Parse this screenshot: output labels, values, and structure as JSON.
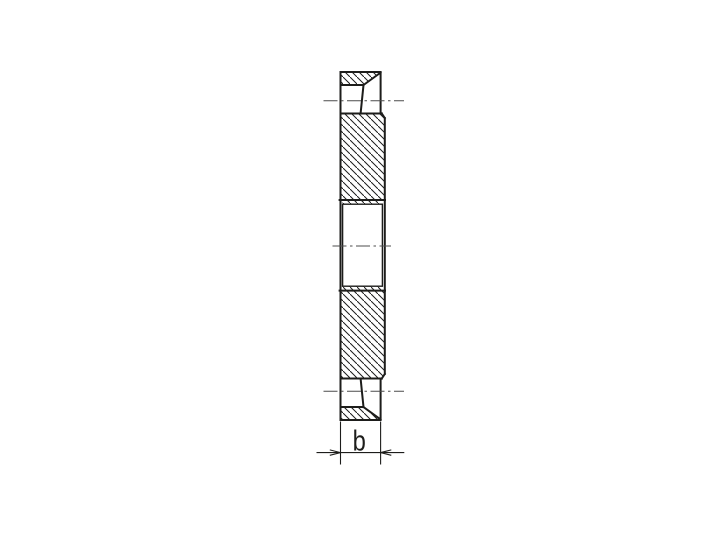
{
  "drawing": {
    "dimension_label": "b",
    "colors": {
      "background": "#ffffff",
      "line": "#1d1d1b",
      "centerline": "#4c4c4c",
      "hatch": "#1c1c1c"
    }
  }
}
